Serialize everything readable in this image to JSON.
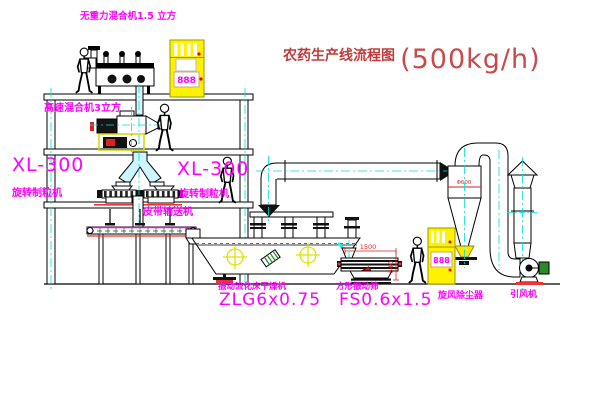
{
  "title": {
    "text": "农药生产线流程图",
    "capacity": "(500kg/h)"
  },
  "labels": {
    "gravity_free_mixer": "无重力混合机1.5 立方",
    "high_speed_mixer": "高速混合机3立方",
    "granulator_left_model": "XL-300",
    "granulator_left_name": "旋转制粒机",
    "granulator_right_model": "XL-300",
    "granulator_right_name": "旋转制粒机",
    "belt_conveyor": "皮带输送机",
    "dryer_name": "振动流化床干燥机",
    "dryer_model": "ZLG6x0.75",
    "screen_name": "方形振动筛",
    "screen_model": "FS0.6x1.5",
    "cyclone": "旋风除尘器",
    "fan": "引风机"
  },
  "dimensions": {
    "screen_length": "1500",
    "screen_height": "540",
    "cyclone_note": "Φ600"
  },
  "cabinets": {
    "display_value": "888"
  },
  "colors": {
    "label_magenta": "#ff00ff",
    "title_red": "#c03c3c",
    "centerline_cyan": "#00dddd",
    "cabinet_yellow": "#fff200",
    "dim_red": "#dd2222",
    "belt_green": "#00aa00"
  }
}
